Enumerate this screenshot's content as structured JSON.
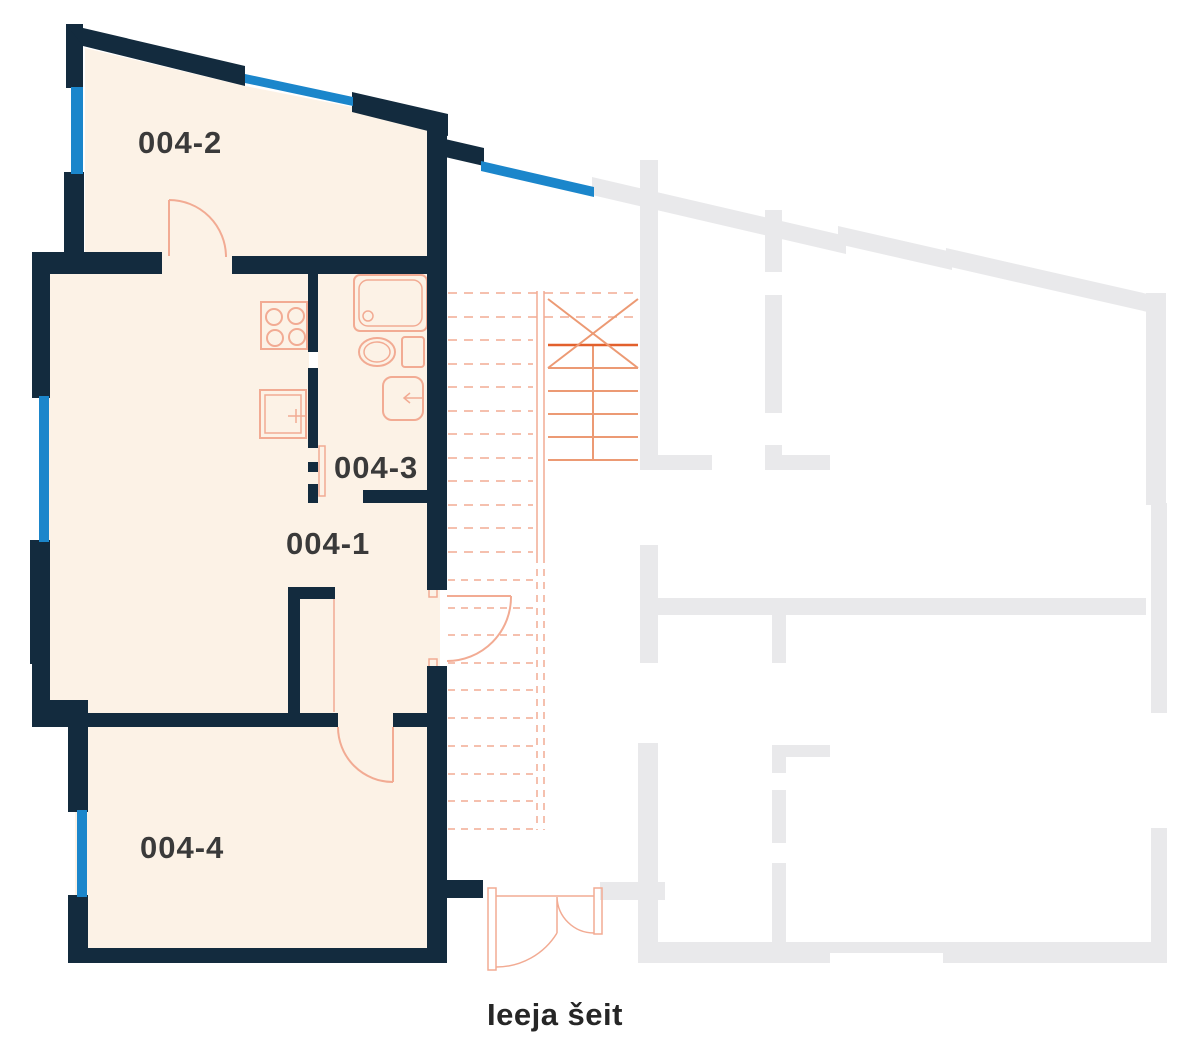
{
  "plan": {
    "rooms": [
      {
        "id": "004-2",
        "label": "004-2"
      },
      {
        "id": "004-3",
        "label": "004-3"
      },
      {
        "id": "004-1",
        "label": "004-1"
      },
      {
        "id": "004-4",
        "label": "004-4"
      }
    ],
    "entrance_label": "Ieeja šeit",
    "colors": {
      "wall_navy": "#132b3e",
      "window_blue": "#1b86cb",
      "floor_cream": "#fcf2e6",
      "fixture_salmon": "#f2ab93",
      "fixture_salmon_mid": "#ec9a74",
      "fixture_salmon_strong": "#e2602c",
      "inactive_gray": "#e9e9eb",
      "label_color": "#3a3a3a",
      "entrance_label_color": "#262626",
      "background": "#ffffff"
    }
  }
}
